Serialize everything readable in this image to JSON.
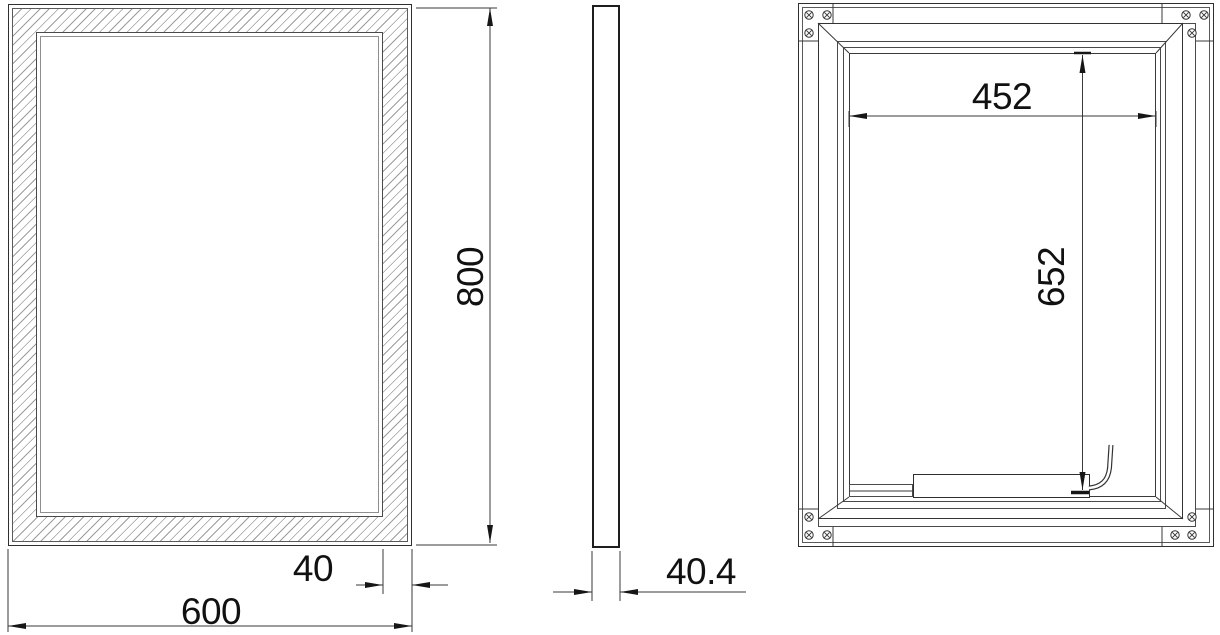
{
  "drawing": {
    "type": "technical-orthographic-drawing",
    "subject": "rectangular framed mirror panel, three views",
    "colors": {
      "background": "#ffffff",
      "line": "#3a3a3a",
      "text": "#111111",
      "hatch": "#9c9c9c"
    },
    "views": {
      "front": {
        "width_label": "600",
        "height_label": "800",
        "frame_width_label": "40"
      },
      "side": {
        "thickness_label": "40.4"
      },
      "back": {
        "inner_width_label": "452",
        "inner_height_label": "652",
        "corner_screw_count": 12
      }
    }
  }
}
